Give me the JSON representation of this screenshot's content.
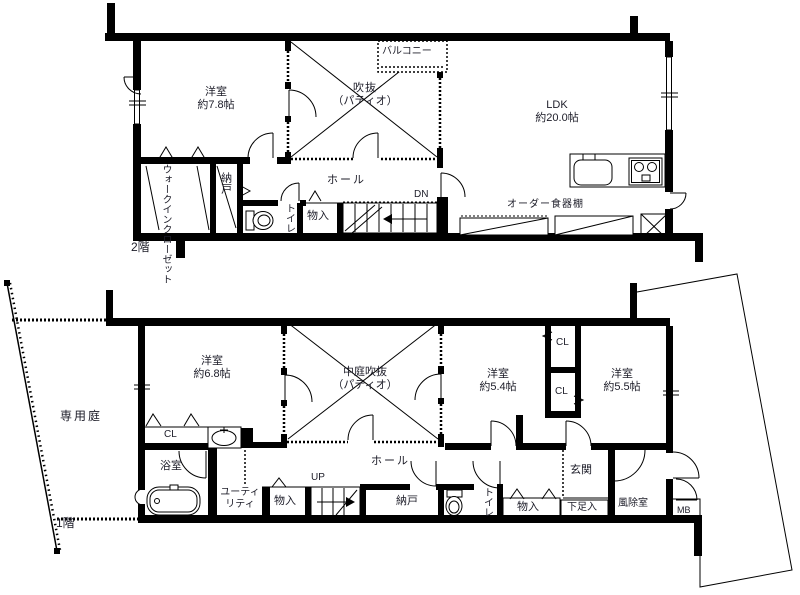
{
  "title": "間取り図（2階・1階）",
  "colors": {
    "wall": "#000000",
    "text": "#1c1c28",
    "background": "#ffffff"
  },
  "icons": [
    "toilet-icon",
    "bathtub-icon",
    "washbasin-icon",
    "kitchen-sink-icon",
    "stove-icon",
    "stairs-icon",
    "shaft-x-icon",
    "door-arc-icon"
  ],
  "floor2": {
    "floor_label": "2階",
    "bedroom": {
      "name": "洋室",
      "size": "約7.8帖"
    },
    "void": {
      "name": "吹抜",
      "sub": "（パティオ）"
    },
    "balcony": "バルコニー",
    "ldk": {
      "name": "LDK",
      "size": "約20.0帖"
    },
    "cupboard": "オーダー食器棚",
    "hall": "ホール",
    "dn": "DN",
    "wic": "ウォークインクローゼット",
    "nando": "納戸",
    "toilet": "トイレ",
    "mono": "物入"
  },
  "floor1": {
    "floor_label": "1階",
    "garden": "専用庭",
    "bedroom68": {
      "name": "洋室",
      "size": "約6.8帖"
    },
    "void": {
      "name": "中庭吹抜",
      "sub": "（パティオ）"
    },
    "bedroom54": {
      "name": "洋室",
      "size": "約5.4帖"
    },
    "bedroom55": {
      "name": "洋室",
      "size": "約5.5帖"
    },
    "cl_top": "CL",
    "cl_mid": "CL",
    "cl_left": "CL",
    "bath": "浴室",
    "utility1": "ユーティ",
    "utility2": "リティ",
    "mono_left": "物入",
    "up": "UP",
    "hall": "ホール",
    "nando": "納戸",
    "toilet": "トイレ",
    "mono_right": "物入",
    "shoes": "下足入",
    "entrance": "玄関",
    "windbreak": "風除室",
    "mb": "MB"
  }
}
